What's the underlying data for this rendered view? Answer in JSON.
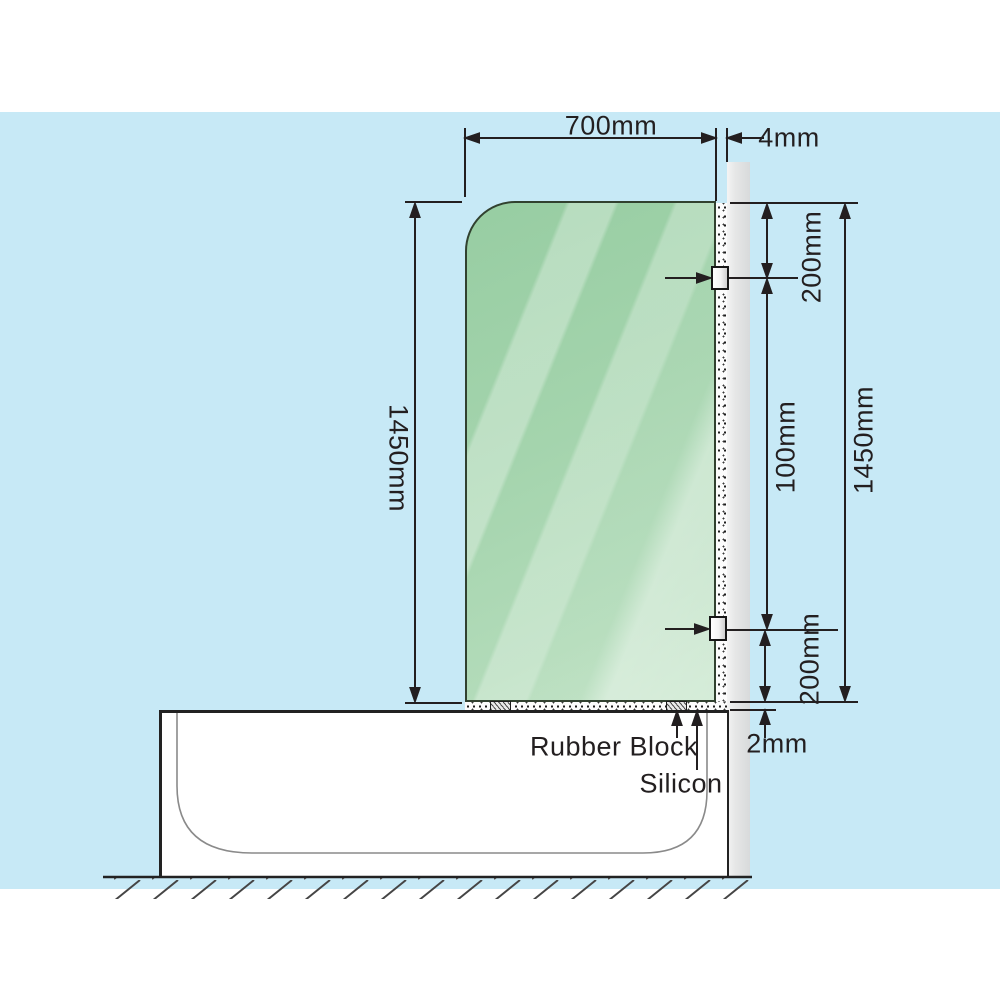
{
  "diagram": {
    "description": "Bath shower screen installation side-view diagram",
    "dimensions": {
      "glass_width": "700mm",
      "wall_gap": "4mm",
      "glass_height_left": "1450mm",
      "bracket_top_offset": "200mm",
      "bracket_mid_offset": "100mm",
      "glass_height_right": "1450mm",
      "bracket_bottom_offset": "200mm",
      "base_gap": "2mm"
    },
    "callouts": {
      "rubber_block": "Rubber Block",
      "silicon": "Silicon"
    },
    "colors": {
      "background_blue": "#c7e9f6",
      "glass_green": "#a4d4ad",
      "wall_grey": "#dcdddd",
      "line_black": "#231f20",
      "tub_white": "#ffffff"
    }
  }
}
